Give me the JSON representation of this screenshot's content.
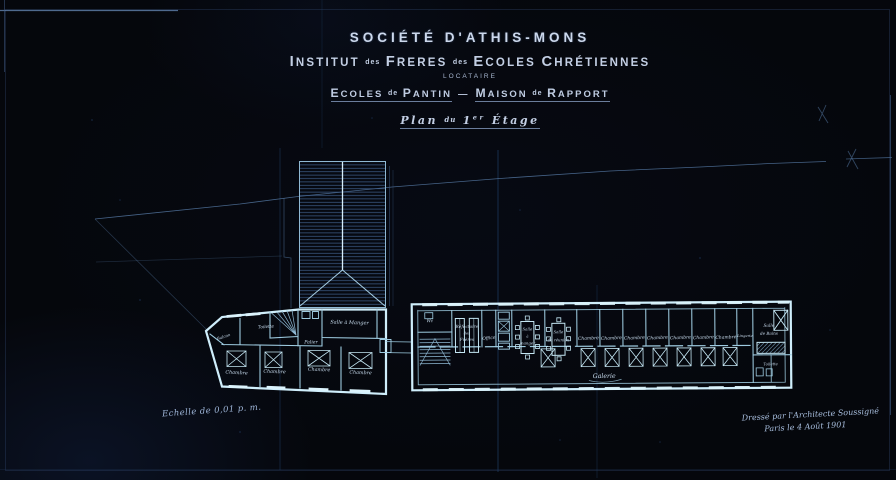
{
  "colors": {
    "background": "#05070c",
    "wall_bright": "#cfeefb",
    "wall_mid": "#9ecbe0",
    "line_dim": "#4e6d96",
    "text_light": "#c7d3e7",
    "hatch_blue": "#3f5e8a"
  },
  "title_block": {
    "company": "SOCIÉTÉ D'ATHIS-MONS",
    "institute": {
      "w1": "INSTITUT",
      "sep1": "des",
      "w2": "FRERES",
      "sep2": "des",
      "w3": "ECOLES",
      "w4": "CHRÉTIENNES"
    },
    "tenant": "LOCATAIRE",
    "project": {
      "w1": "ECOLES",
      "sep1": "de",
      "w2": "PANTIN",
      "dash": "—",
      "w3": "MAISON",
      "sep2": "de",
      "w4": "RAPPORT"
    },
    "plan_title": {
      "w1": "Plan",
      "w2": "du",
      "num": "1",
      "sup": "er",
      "w3": "Étage"
    }
  },
  "annotations": {
    "scale_note": "Echelle de 0,01 p. m.",
    "signature_line1": "Dressé par l'Architecte Soussigné",
    "signature_line2": "Paris le 4 Août 1901"
  },
  "plan": {
    "annex": {
      "balcony_label": "Balcon",
      "toilet_label": "Toilette",
      "landing_label": "Palier",
      "dining_label": "Salle à Manger",
      "bedrooms": [
        "Chambre",
        "Chambre",
        "Chambre",
        "Chambre"
      ]
    },
    "main_building": {
      "wc_label": "Wc",
      "refectory": {
        "l1": "Réfectoire",
        "l2": "des",
        "l3": "Frères"
      },
      "office_label": "Office",
      "dining_a": {
        "l1": "Salle",
        "l2": "à",
        "l3": "manger"
      },
      "dining_b": {
        "l1": "Salle",
        "l2": "de réunion"
      },
      "bedrooms": [
        "Chambre",
        "Chambre",
        "Chambre",
        "Chambre",
        "Chambre",
        "Chambre",
        "Chambre"
      ],
      "linen_label": "Lingerie",
      "bath": {
        "l1": "Salle",
        "l2": "de Bains"
      },
      "toilet_label": "Toilette",
      "corridor_label": "Galerie"
    }
  }
}
